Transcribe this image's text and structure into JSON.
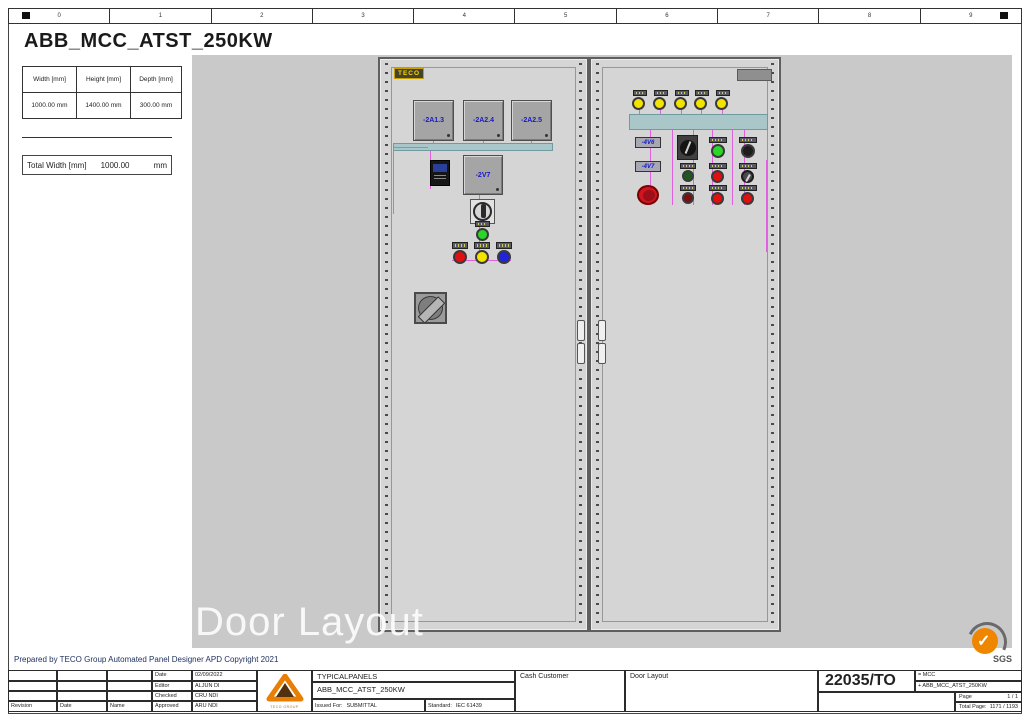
{
  "palette": {
    "canvas_gray": "#c9c9c9",
    "door_gray": "#d5d5d5",
    "duct_teal": "#a9c6c9",
    "wire_magenta": "#e060e0",
    "device_label_blue": "#1a1ac0",
    "pilot_yellow": "#f2e400",
    "pilot_green": "#28d828",
    "pilot_red": "#e01010",
    "pilot_blue": "#2025d8",
    "logo_orange": "#ef8600",
    "brand_yellow": "#ffd400"
  },
  "ruler": {
    "labels": [
      "0",
      "1",
      "2",
      "3",
      "4",
      "5",
      "6",
      "7",
      "8",
      "9"
    ]
  },
  "header": {
    "title": "ABB_MCC_ATST_250KW"
  },
  "dimensions_table": {
    "headers": [
      "Width [mm]",
      "Height [mm]",
      "Depth [mm]"
    ],
    "values": [
      "1000.00 mm",
      "1400.00 mm",
      "300.00 mm"
    ]
  },
  "total_width": {
    "label": "Total Width [mm]",
    "value": "1000.00",
    "unit": "mm"
  },
  "left_panel": {
    "brand": "TECO",
    "devices": [
      "-2A1.3",
      "-2A2.4",
      "-2A2.5"
    ],
    "drive": "-2V7"
  },
  "right_panel": {
    "labels": [
      "-4V6",
      "-4V7"
    ]
  },
  "watermark": "Door Layout",
  "footer_note": "Prepared by TECO Group Automated Panel Designer APD Copyright 2021",
  "title_block": {
    "revision_columns": [
      "Revision",
      "Date",
      "Name"
    ],
    "meta_rows": [
      {
        "label": "Date",
        "value": "02/09/2022"
      },
      {
        "label": "Editor",
        "value": "ALJUN DI"
      },
      {
        "label": "Checked",
        "value": "CRU NDI"
      },
      {
        "label": "Approved",
        "value": "ARU NDI"
      }
    ],
    "logo_caption": "TECO GROUP",
    "project": "TYPICALPANELS",
    "drawing_title": "ABB_MCC_ATST_250KW",
    "issued_for_label": "Issued For:",
    "issued_for_value": "SUBMITTAL",
    "standard_label": "Standard:",
    "standard_value": "IEC 61439",
    "customer": "Cash Customer",
    "sheet_name": "Door Layout",
    "drawing_number": "22035/TO",
    "function_ref": "= MCC",
    "location_ref": "+ ABB_MCC_ATST_250KW",
    "page_label": "Page",
    "page_value": "1 / 1",
    "total_page_label": "Total Page:",
    "total_page_value": "1171 / 1193"
  },
  "certification": {
    "mark": "SGS"
  }
}
